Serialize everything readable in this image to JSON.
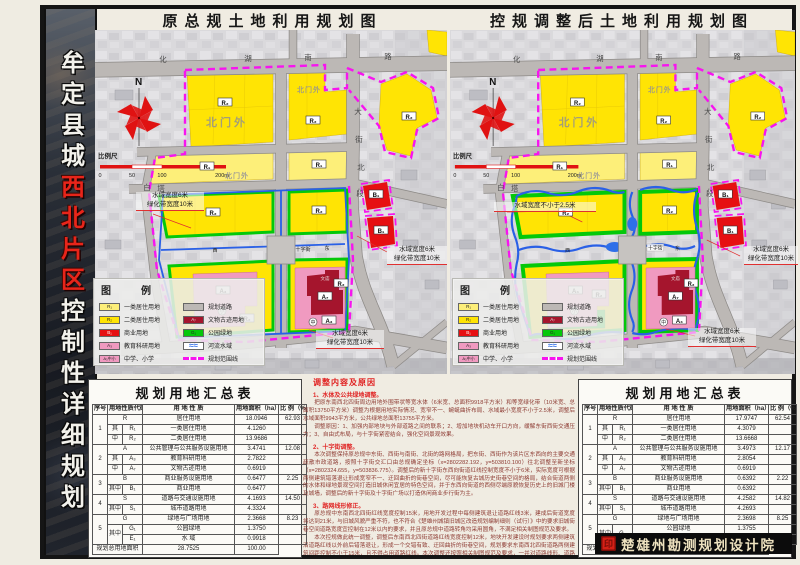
{
  "page": {
    "side_title": {
      "part1": "牟定县城",
      "part2": "西北片区",
      "part3": "控制性详细规划"
    },
    "footer": {
      "institute": "楚雄州勘测规划设计院",
      "seal": "印"
    }
  },
  "maps": {
    "left_title": "原总规土地利用规划图",
    "right_title": "控规调整后土地利用规划图",
    "labels": {
      "north": "N",
      "r1": "R₁",
      "r2": "R₂",
      "a3": "A₃",
      "a7": "A₇",
      "b1": "B₁",
      "beimenwai": "北门外",
      "wenmiao": "文庙",
      "shizijie": "十字街",
      "zhong": "中",
      "xiao": "小",
      "xi": "西",
      "dong": "东",
      "road_top": [
        "化",
        "湖",
        "南",
        "路"
      ],
      "road_right": [
        "大",
        "街",
        "北",
        "段"
      ],
      "road_baita": [
        "白",
        "塔"
      ],
      "scale_title": "比例尺",
      "scale_ticks": [
        "0",
        "50",
        "100",
        "200m"
      ]
    },
    "annotations": {
      "water6": "水域宽度6米",
      "green10": "绿化带宽度10米",
      "water25": "水域宽度不小于2.5米"
    }
  },
  "legend": {
    "title": "图　例",
    "col1": [
      {
        "sw": "r1",
        "code": "R₁",
        "label": "一类居住用地"
      },
      {
        "sw": "r2",
        "code": "R₂",
        "label": "二类居住用地"
      },
      {
        "sw": "b1",
        "code": "B₁",
        "label": "商业用地"
      },
      {
        "sw": "a3",
        "code": "A₃",
        "label": "教育科研用地"
      },
      {
        "sw": "a3s",
        "code": "A₃中小",
        "label": "中学、小学"
      }
    ],
    "col2": [
      {
        "sw": "road",
        "code": "",
        "label": "规划道路"
      },
      {
        "sw": "a7",
        "code": "A₇",
        "label": "文物古迹用地"
      },
      {
        "sw": "g1",
        "code": "G₁",
        "label": "公园绿地"
      },
      {
        "sw": "river",
        "code": "",
        "label": "河流水域"
      },
      {
        "sw": "bound",
        "code": "",
        "label": "规划范围线"
      }
    ]
  },
  "tables": {
    "left": {
      "title": "规划用地汇总表",
      "header": [
        {
          "t": "序号"
        },
        {
          "t": "用地性质代码",
          "cs": 2
        },
        {
          "t": "用 地 性 质"
        },
        {
          "t": "用地面积（ha）"
        },
        {
          "t": "比 例（%）"
        }
      ],
      "rows": [
        [
          {
            "t": "1",
            "rs": 3
          },
          {
            "t": "R",
            "cs": 2
          },
          {
            "t": "居住用地"
          },
          {
            "t": "18.0946"
          },
          {
            "t": "62.93"
          }
        ],
        [
          {
            "t": "其"
          },
          {
            "t": "R₁"
          },
          {
            "t": "一类居住用地"
          },
          {
            "t": "4.1260"
          },
          {
            "t": ""
          }
        ],
        [
          {
            "t": "中"
          },
          {
            "t": "R₂"
          },
          {
            "t": "二类居住用地"
          },
          {
            "t": "13.9686"
          },
          {
            "t": ""
          }
        ],
        [
          {
            "t": "2",
            "rs": 3
          },
          {
            "t": "A",
            "cs": 2
          },
          {
            "t": "公共管理与公共服务设施用地"
          },
          {
            "t": "3.4741"
          },
          {
            "t": "12.08"
          }
        ],
        [
          {
            "t": "其"
          },
          {
            "t": "A₃"
          },
          {
            "t": "教育科研用地"
          },
          {
            "t": "2.7822"
          },
          {
            "t": ""
          }
        ],
        [
          {
            "t": "中"
          },
          {
            "t": "A₇"
          },
          {
            "t": "文物古迹用地"
          },
          {
            "t": "0.6919"
          },
          {
            "t": ""
          }
        ],
        [
          {
            "t": "3",
            "rs": 2
          },
          {
            "t": "B",
            "cs": 2
          },
          {
            "t": "商业服务设施用地"
          },
          {
            "t": "0.6477"
          },
          {
            "t": "2.25"
          }
        ],
        [
          {
            "t": "其中"
          },
          {
            "t": "B₁"
          },
          {
            "t": "商业用地"
          },
          {
            "t": "0.6477"
          },
          {
            "t": ""
          }
        ],
        [
          {
            "t": "4",
            "rs": 2
          },
          {
            "t": "S",
            "cs": 2
          },
          {
            "t": "道路与交通设施用地"
          },
          {
            "t": "4.1693"
          },
          {
            "t": "14.50"
          }
        ],
        [
          {
            "t": "其中"
          },
          {
            "t": "S₁"
          },
          {
            "t": "城市道路用地"
          },
          {
            "t": "4.3324"
          },
          {
            "t": ""
          }
        ],
        [
          {
            "t": "5",
            "rs": 3
          },
          {
            "t": "G",
            "cs": 2
          },
          {
            "t": "绿地与广场用地"
          },
          {
            "t": "2.3668"
          },
          {
            "t": "8.23"
          }
        ],
        [
          {
            "t": "其中",
            "rs": 2
          },
          {
            "t": "G₁"
          },
          {
            "t": "公园绿地"
          },
          {
            "t": "1.3750"
          },
          {
            "t": ""
          }
        ],
        [
          {
            "t": "E₁"
          },
          {
            "t": "水 域"
          },
          {
            "t": "0.9918"
          },
          {
            "t": ""
          }
        ],
        [
          {
            "t": "规划总用地面积",
            "cs": 3
          },
          {
            "t": "28.7525"
          },
          {
            "t": "100.00"
          }
        ]
      ]
    },
    "right": {
      "title": "规划用地汇总表",
      "header": [
        {
          "t": "序号"
        },
        {
          "t": "用地性质代码",
          "cs": 2
        },
        {
          "t": "用 地 性 质"
        },
        {
          "t": "用地面积（ha）"
        },
        {
          "t": "比 例（%）"
        }
      ],
      "rows": [
        [
          {
            "t": "1",
            "rs": 3
          },
          {
            "t": "R",
            "cs": 2
          },
          {
            "t": "居住用地"
          },
          {
            "t": "17.9747"
          },
          {
            "t": "62.54"
          }
        ],
        [
          {
            "t": "其"
          },
          {
            "t": "R₁"
          },
          {
            "t": "一类居住用地"
          },
          {
            "t": "4.3079"
          },
          {
            "t": ""
          }
        ],
        [
          {
            "t": "中"
          },
          {
            "t": "R₂"
          },
          {
            "t": "二类居住用地"
          },
          {
            "t": "13.6668"
          },
          {
            "t": ""
          }
        ],
        [
          {
            "t": "2",
            "rs": 3
          },
          {
            "t": "A",
            "cs": 2
          },
          {
            "t": "公共管理与公共服务设施用地"
          },
          {
            "t": "3.4973"
          },
          {
            "t": "12.17"
          }
        ],
        [
          {
            "t": "其"
          },
          {
            "t": "A₃"
          },
          {
            "t": "教育科研用地"
          },
          {
            "t": "2.8054"
          },
          {
            "t": ""
          }
        ],
        [
          {
            "t": "中"
          },
          {
            "t": "A₇"
          },
          {
            "t": "文物古迹用地"
          },
          {
            "t": "0.6919"
          },
          {
            "t": ""
          }
        ],
        [
          {
            "t": "3",
            "rs": 2
          },
          {
            "t": "B",
            "cs": 2
          },
          {
            "t": "商业服务设施用地"
          },
          {
            "t": "0.6392"
          },
          {
            "t": "2.22"
          }
        ],
        [
          {
            "t": "其中"
          },
          {
            "t": "B₁"
          },
          {
            "t": "商业用地"
          },
          {
            "t": "0.6392"
          },
          {
            "t": ""
          }
        ],
        [
          {
            "t": "4",
            "rs": 2
          },
          {
            "t": "S",
            "cs": 2
          },
          {
            "t": "道路与交通设施用地"
          },
          {
            "t": "4.2582"
          },
          {
            "t": "14.82"
          }
        ],
        [
          {
            "t": "其中"
          },
          {
            "t": "S₁"
          },
          {
            "t": "城市道路用地"
          },
          {
            "t": "4.2693"
          },
          {
            "t": ""
          }
        ],
        [
          {
            "t": "5",
            "rs": 3
          },
          {
            "t": "G",
            "cs": 2
          },
          {
            "t": "绿地与广场用地"
          },
          {
            "t": "2.3698"
          },
          {
            "t": "8.25"
          }
        ],
        [
          {
            "t": "其中",
            "rs": 2
          },
          {
            "t": "G₁",
            "rs": 2
          },
          {
            "t": "公园绿地"
          },
          {
            "t": "1.3755"
          },
          {
            "t": ""
          }
        ],
        [
          {
            "t": "水 域"
          },
          {
            "t": "0.9943"
          },
          {
            "t": ""
          }
        ],
        [
          {
            "t": "规划总用地面积",
            "cs": 3
          },
          {
            "t": "28.7392"
          },
          {
            "t": "100.00"
          }
        ]
      ]
    }
  },
  "notes": {
    "title": "调整内容及原因",
    "sections": [
      {
        "h": "1、水体及公共绿地调整。",
        "ps": [
          "把原东南西北四街周边用地外围带状等宽水体（6米宽、总面积9918平方米）和等宽绿化带（10米宽、总面积13750平方米）调整为根据用地实际情况、宽窄不一、蜿蜒曲折布局、水域最小宽度不小于2.5米，调整后水域面积9943平方米，公共绿地总面积13755平方米。",
          "调整原因：1、加强内部地块与外部道路之间的联系；2、增加地块机动车开口方向，缓解东街西街交通压力；3、自由式布局，与十字街紧密结合，强化空间景观效果。"
        ]
      },
      {
        "h": "2、十字街调整。",
        "ps": [
          "本次调整保持原总规中东街、西街与南街、北街的路网格局，把东街、西街作为该片区东西向的主要交通疏散市政道路，按照十字街交汇口由总规确定坐标（x=2802282.192，y=503810.100）往北调整至新坐标（x=2802324.655，y=503836.775）。调整后的新十字街东西向街道红线控制宽度不小于6米，实际宽度可根据两侧建筑错落退让形成宽窄不一、迂回曲折的街巷空间，尽可能恢复古城历史街巷空间的格局，结合街道两侧的水体和绿地景观空间打造旧城休闲宜居的特色空间，并于东西向街道的西侧尽端原貌恢复历史上的旧城门楼及城墙，调整后的新十字街及十字街广场以打造休闲商业步行街为主。"
        ]
      },
      {
        "h": "3、路网线形修正。",
        "ps": [
          "原总规中东南西北四街红线宽度控制15米，用地开发过程中每侧建筑退让道路红线3米，建成后街道宽度将达到21米，与旧城风貌严重不符，也不符合《楚雄州城镇旧城区改造规划编制细则（试行）》中的要求旧城街巷空间道路宽度宜控制在12米以内的要求，并且原总规中道路转角均采用圆角，不满足相关制图规范及要求。",
          "本次控规做此统一调整，调整后东南西北四街道路红线宽度控制12米，地块开发建设时规划要求两侧建筑沿道路红线以外前后错落退让，形成一个交错有致、迂回曲折的街巷空间，规划要求东南西北四街道路两侧建筑间距控制不小于15米，且不得占用道路红线。本次调整还按照相关制图规范及要求，一并对道路线形、道路转角进行修正调整。"
        ]
      }
    ]
  }
}
